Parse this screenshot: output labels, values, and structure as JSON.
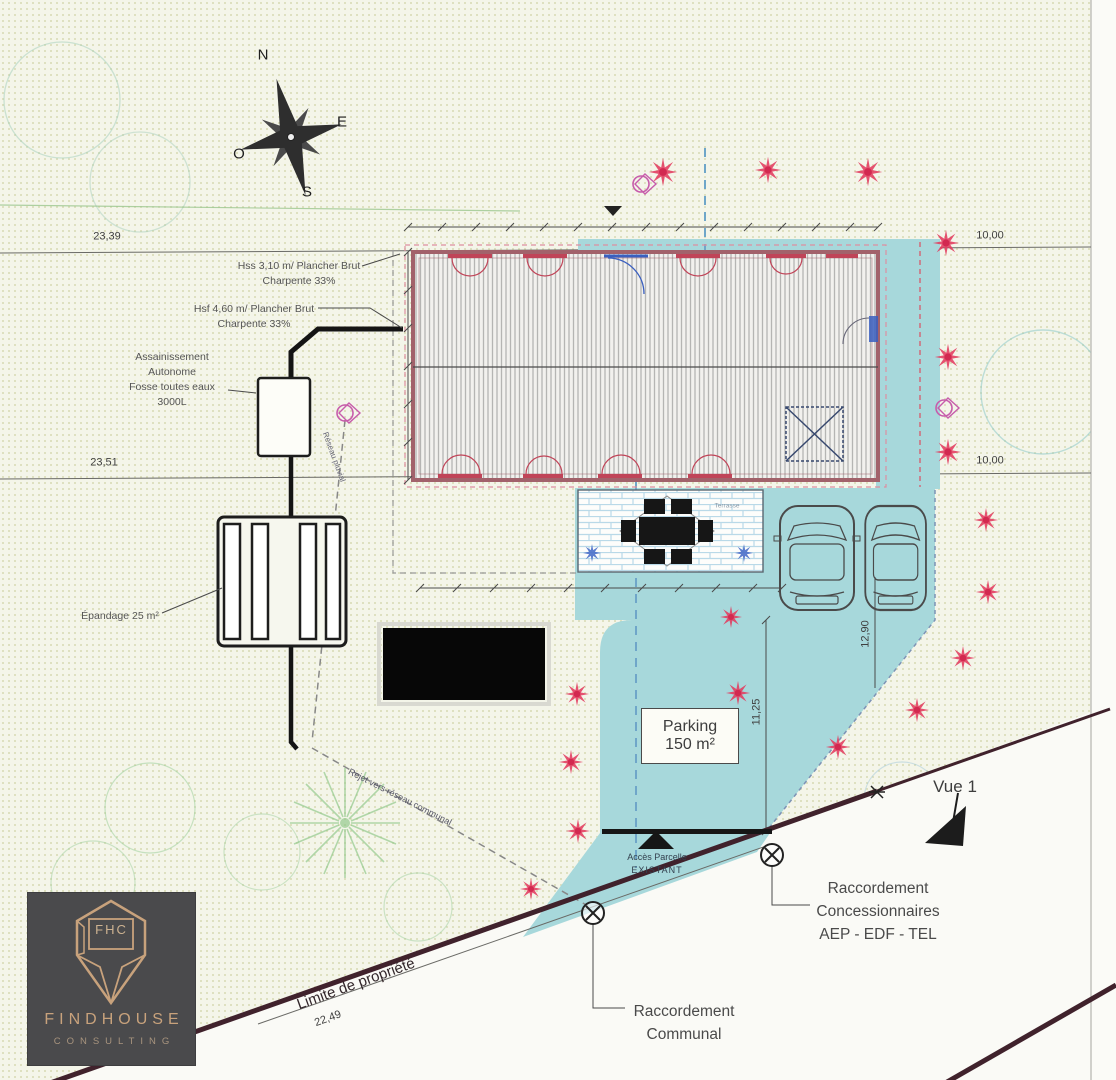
{
  "compass": {
    "n": "N",
    "e": "E",
    "s": "S",
    "o": "O"
  },
  "dimensions": {
    "top_left": "23,39",
    "top_right": "10,00",
    "mid_left": "23,51",
    "mid_right": "10,00",
    "road": "22,49",
    "parking_height": "11,25",
    "parking_side": "12,90"
  },
  "building": {
    "hss_line1": "Hss 3,10 m/ Plancher Brut",
    "hss_line2": "Charpente 33%",
    "hsf_line1": "Hsf 4,60 m/ Plancher Brut",
    "hsf_line2": "Charpente 33%"
  },
  "sanitation": {
    "line1": "Assainissement",
    "line2": "Autonome",
    "line3": "Fosse toutes eaux",
    "line4": "3000L",
    "epandage": "Épandage 25 m²",
    "rejet": "Rejet vers réseau communal",
    "pluvial": "Réseau pluvial"
  },
  "site": {
    "parking_line1": "Parking",
    "parking_line2": "150 m²",
    "terrasse": "Terrasse",
    "vue": "Vue 1",
    "acces_line1": "Accès Parcelle",
    "acces_line2": "EXISTANT",
    "limite": "Limite de propriété",
    "racc_communal_line1": "Raccordement",
    "racc_communal_line2": "Communal",
    "racc_conc_line1": "Raccordement",
    "racc_conc_line2": "Concessionnaires",
    "racc_conc_line3": "AEP - EDF - TEL"
  },
  "logo": {
    "monogram": "FHC",
    "name": "FINDHOUSE",
    "subtitle": "CONSULTING"
  },
  "colors": {
    "paper": "#f4f5e9",
    "teal": "#a7d8db",
    "shrub_red": "#e23b5f",
    "wall_red": "#a2626b",
    "logo_gold": "#c8a27c",
    "property_line": "#40222c"
  }
}
